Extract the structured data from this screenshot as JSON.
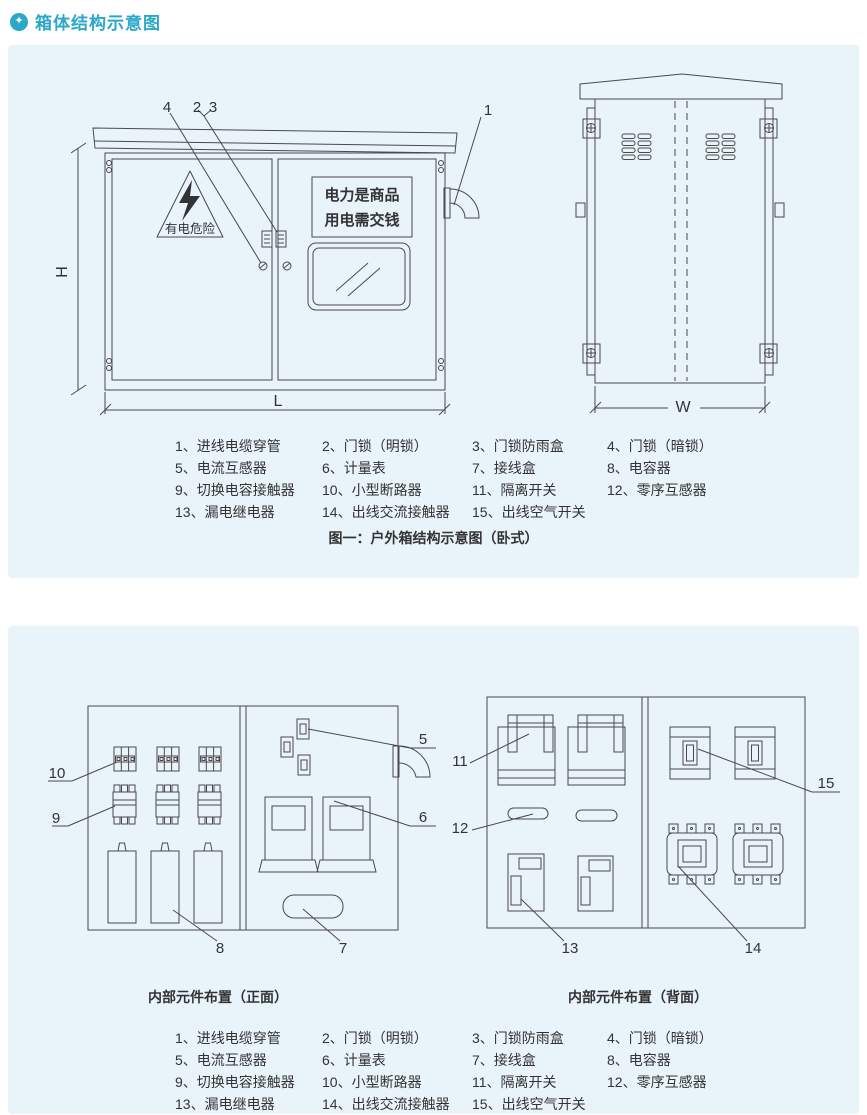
{
  "title": {
    "icon": "✦",
    "text": "箱体结构示意图"
  },
  "colors": {
    "accent": "#2BA7C9",
    "panel_bg": "#E9F3FA",
    "line": "#4A4A4A",
    "text": "#333333"
  },
  "figure1": {
    "caption": "图一：户外箱结构示意图（卧式）",
    "front_view": {
      "warning_text": "有电危险",
      "sign_line1": "电力是商品",
      "sign_line2": "用电需交钱",
      "dim_h": "H",
      "dim_l": "L",
      "callout_1": "1",
      "callout_2": "2",
      "callout_3": "3",
      "callout_4": "4"
    },
    "back_view": {
      "dim_w": "W"
    }
  },
  "figure2": {
    "front_caption": "内部元件布置（正面）",
    "back_caption": "内部元件布置（背面）",
    "callout_5": "5",
    "callout_6": "6",
    "callout_7": "7",
    "callout_8": "8",
    "callout_9": "9",
    "callout_10": "10",
    "callout_11": "11",
    "callout_12": "12",
    "callout_13": "13",
    "callout_14": "14",
    "callout_15": "15"
  },
  "legend": {
    "items": [
      "1、进线电缆穿管",
      "2、门锁（明锁）",
      "3、门锁防雨盒",
      "4、门锁（暗锁）",
      "5、电流互感器",
      "6、计量表",
      "7、接线盒",
      "8、电容器",
      "9、切换电容接触器",
      "10、小型断路器",
      "11、隔离开关",
      "12、零序互感器",
      "13、漏电继电器",
      "14、出线交流接触器",
      "15、出线空气开关"
    ]
  }
}
